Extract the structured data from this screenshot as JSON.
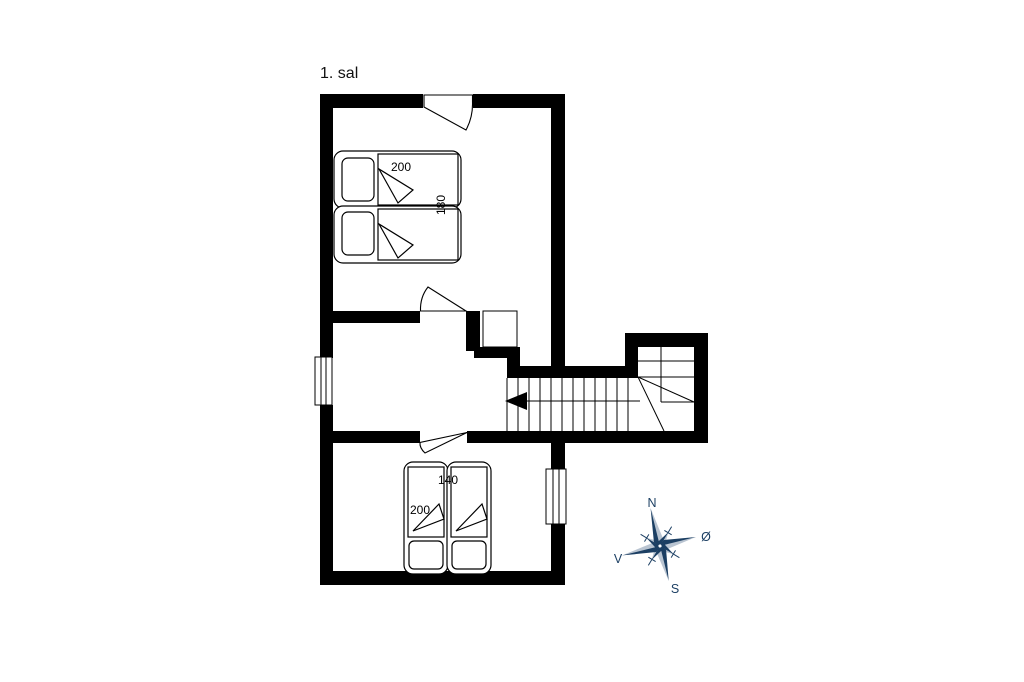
{
  "title": "1. sal",
  "beds": {
    "double_bed": {
      "length_label": "200",
      "width_label": "180"
    },
    "twin_bed": {
      "width_label": "140",
      "length_label": "200"
    }
  },
  "compass": {
    "north": "N",
    "east": "Ø",
    "south": "S",
    "west": "V"
  },
  "colors": {
    "wall": "#000000",
    "line": "#000000",
    "background": "#ffffff",
    "compass_dark": "#1c3f63",
    "compass_light": "#b9c4d1"
  }
}
